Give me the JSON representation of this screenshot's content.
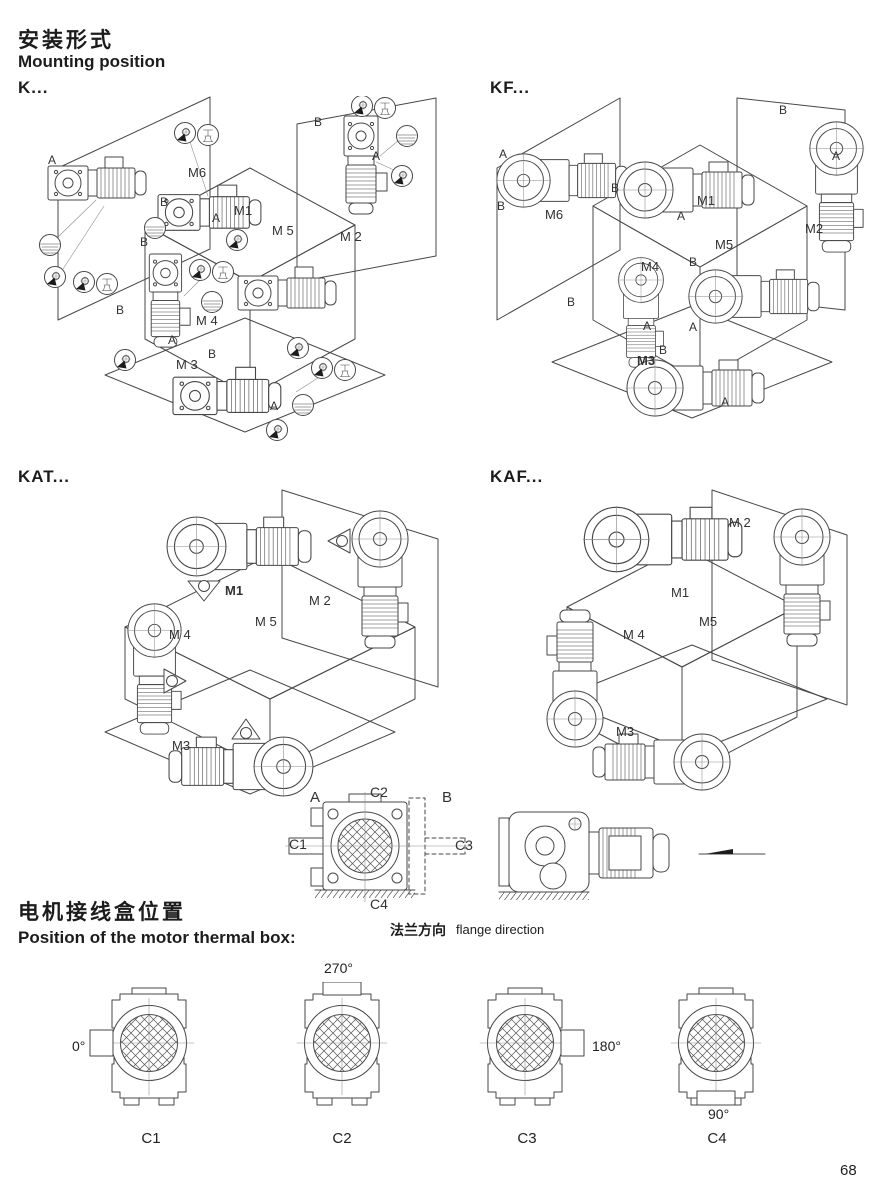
{
  "page": {
    "title_zh": "安装形式",
    "title_en": "Mounting position",
    "page_number": "68"
  },
  "sections": {
    "k": {
      "label": "K...",
      "m1": "M1",
      "m2": "M 2",
      "m3": "M 3",
      "m4": "M 4",
      "m5": "M 5",
      "m6": "M6",
      "a": "A",
      "b": "B"
    },
    "kf": {
      "label": "KF...",
      "m1": "M1",
      "m2": "M2",
      "m3": "M3",
      "m4": "M4",
      "m5": "M5",
      "m6": "M6",
      "a": "A",
      "b": "B"
    },
    "kat": {
      "label": "KAT...",
      "m1": "M1",
      "m2": "M 2",
      "m3": "M3",
      "m4": "M 4",
      "m5": "M 5"
    },
    "kaf": {
      "label": "KAF...",
      "m1": "M1",
      "m2": "M 2",
      "m3": "M3",
      "m4": "M 4",
      "m5": "M5"
    }
  },
  "flange": {
    "a": "A",
    "b": "B",
    "c1": "C1",
    "c2": "C2",
    "c3": "C3",
    "c4": "C4",
    "caption_zh": "法兰方向",
    "caption_en": "flange direction"
  },
  "thermal": {
    "title_zh": "电机接线盒位置",
    "title_en": "Position of the motor thermal box:",
    "views": [
      {
        "name": "C1",
        "angle": "0°"
      },
      {
        "name": "C2",
        "angle": "270°"
      },
      {
        "name": "C3",
        "angle": "180°"
      },
      {
        "name": "C4",
        "angle": "90°"
      }
    ]
  }
}
